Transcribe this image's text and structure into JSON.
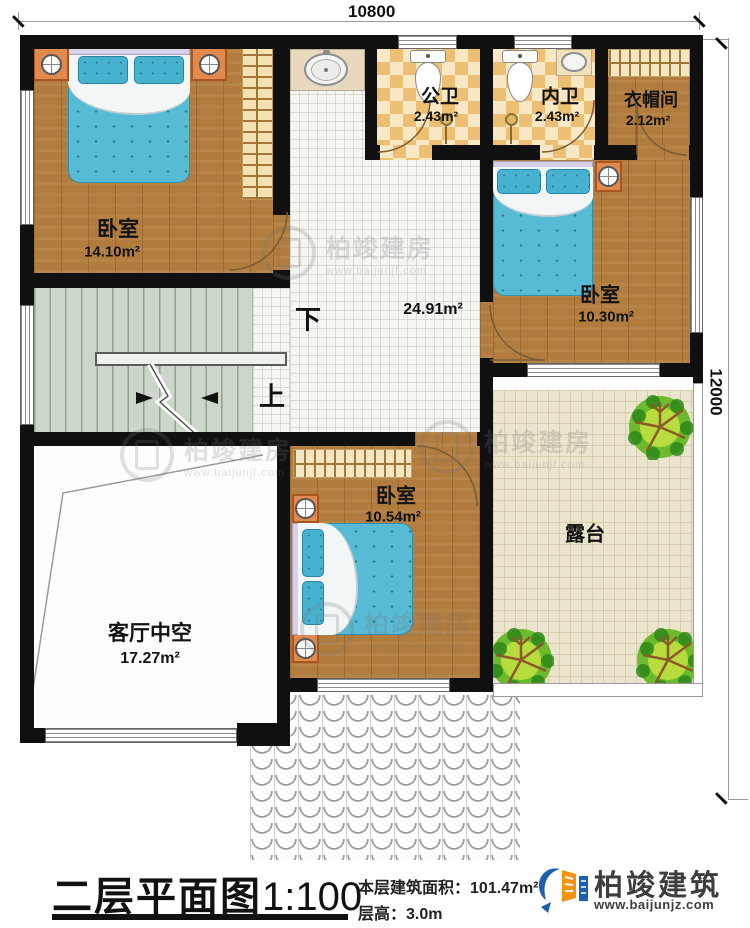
{
  "dimensions": {
    "top": "10800",
    "right": "12000"
  },
  "rooms": {
    "bedroom_top_left": {
      "name": "卧室",
      "area": "14.10m²"
    },
    "public_bathroom": {
      "name": "公卫",
      "area": "2.43m²"
    },
    "private_bathroom": {
      "name": "内卫",
      "area": "2.43m²"
    },
    "cloakroom": {
      "name": "衣帽间",
      "area": "2.12m²"
    },
    "bedroom_right": {
      "name": "卧室",
      "area": "10.30m²"
    },
    "hall": {
      "area": "24.91m²"
    },
    "bedroom_middle": {
      "name": "卧室",
      "area": "10.54m²"
    },
    "living_room_void": {
      "name": "客厅中空",
      "area": "17.27m²"
    },
    "terrace": {
      "name": "露台"
    }
  },
  "stairs": {
    "down": "下",
    "up": "上"
  },
  "title_block": {
    "title": "二层平面图",
    "scale": "1:100",
    "floor_area_label": "本层建筑面积：",
    "floor_area_value": "101.47m²",
    "floor_height_label": "层高：",
    "floor_height_value": "3.0m"
  },
  "brand": {
    "name": "柏竣建筑",
    "website": "www.baijunjz.com"
  },
  "watermark": {
    "name": "柏竣建房",
    "website": "www.baijunjf.com"
  }
}
